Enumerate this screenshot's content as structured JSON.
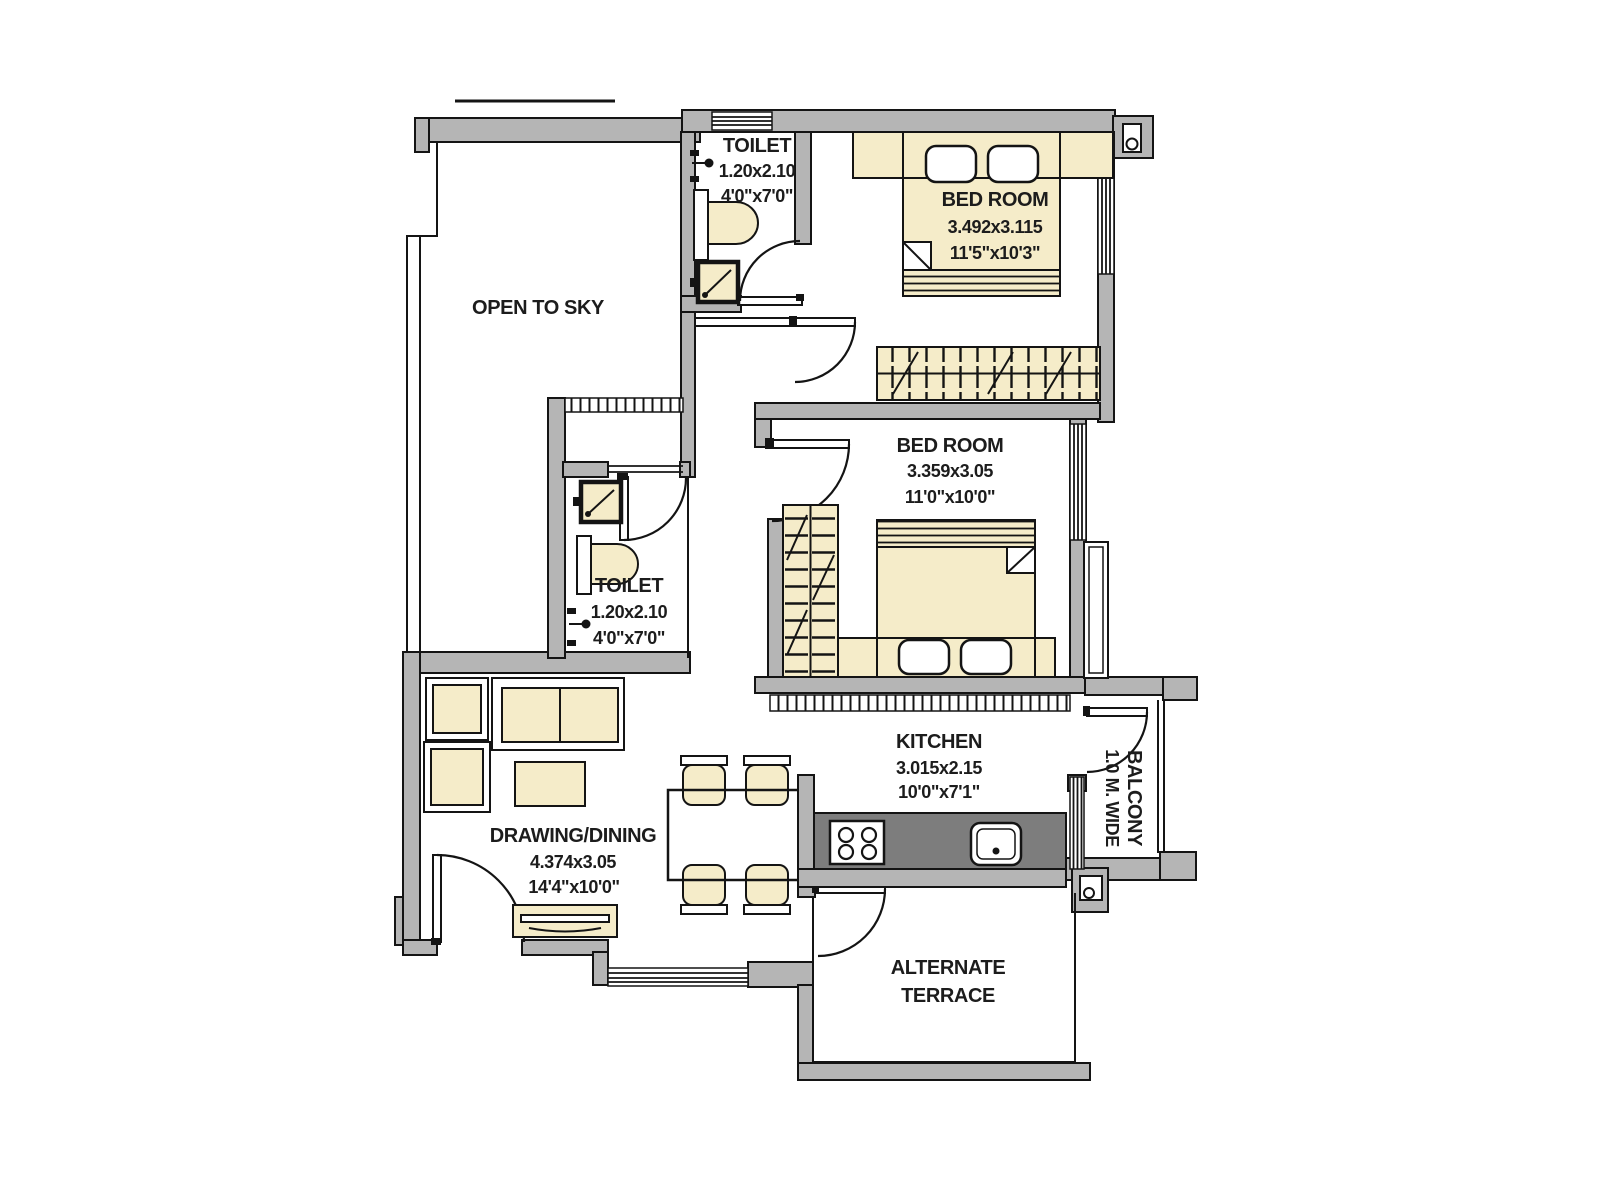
{
  "plan": {
    "type": "apartment-floor-plan",
    "rooms": {
      "open_to_sky": {
        "name": "OPEN TO SKY"
      },
      "toilet_1": {
        "name": "TOILET",
        "size_m": "1.20x2.10",
        "size_ft": "4'0\"x7'0\""
      },
      "bedroom_1": {
        "name": "BED ROOM",
        "size_m": "3.492x3.115",
        "size_ft": "11'5\"x10'3\""
      },
      "bedroom_2": {
        "name": "BED ROOM",
        "size_m": "3.359x3.05",
        "size_ft": "11'0\"x10'0\""
      },
      "toilet_2": {
        "name": "TOILET",
        "size_m": "1.20x2.10",
        "size_ft": "4'0\"x7'0\""
      },
      "kitchen": {
        "name": "KITCHEN",
        "size_m": "3.015x2.15",
        "size_ft": "10'0\"x7'1\""
      },
      "drawing_dining": {
        "name": "DRAWING/DINING",
        "size_m": "4.374x3.05",
        "size_ft": "14'4\"x10'0\""
      },
      "balcony": {
        "name": "BALCONY",
        "size": "1.0 M. WIDE"
      },
      "terrace": {
        "name_line1": "ALTERNATE",
        "name_line2": "TERRACE"
      }
    },
    "colors": {
      "wall": "#b5b5b5",
      "kitchen_counter": "#7d7d7d",
      "furniture": "#f5ecc9",
      "outline": "#141414",
      "background": "#ffffff",
      "label_text": "#1c1c1c"
    }
  }
}
